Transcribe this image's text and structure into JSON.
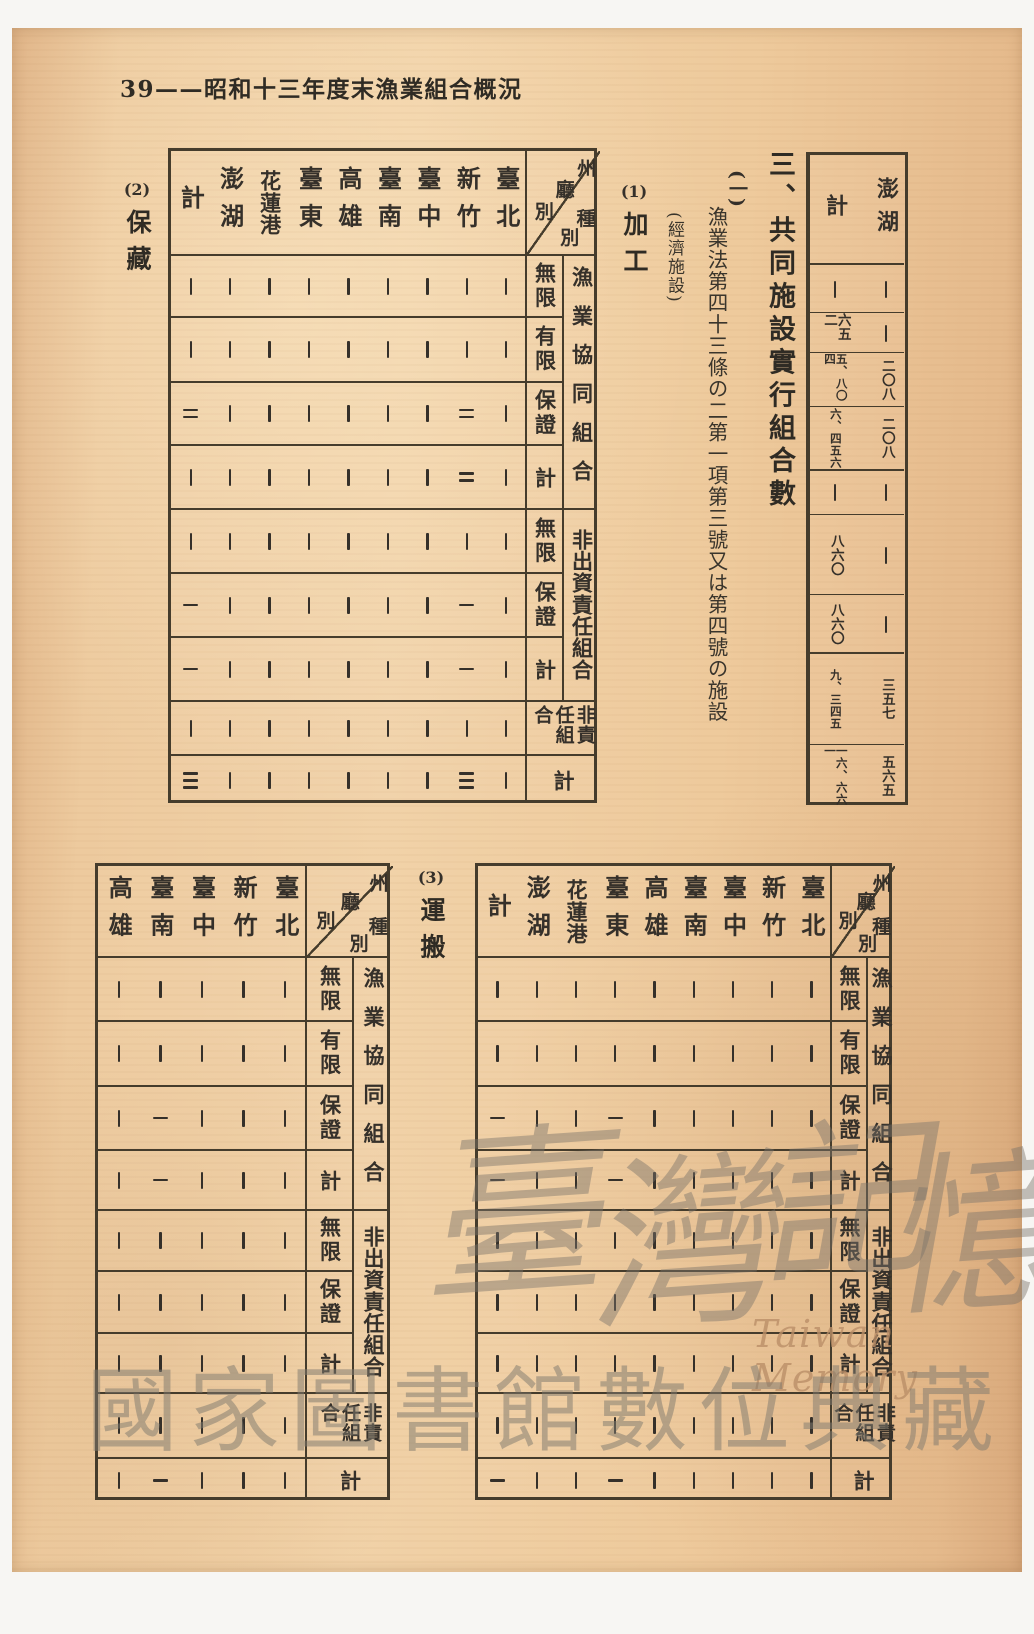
{
  "page_header": "39——昭和十三年度末漁業組合概況",
  "section": {
    "title": "三、共同施設實行組合數",
    "item_marker": "(一)",
    "item_text": "漁業法第四十三條の二第一項第三號又は第四號の施設",
    "item_note": "(經濟施設)"
  },
  "subsections": [
    {
      "num": "(1)",
      "label": "加工"
    },
    {
      "num": "(2)",
      "label": "保藏"
    },
    {
      "num": "(3)",
      "label": "運搬"
    }
  ],
  "axis": {
    "col_axis": "州廳別",
    "row_axis": "種別"
  },
  "row_labels": [
    "無限",
    "有限",
    "保證",
    "計",
    "無限",
    "保證",
    "計",
    "非責任組合",
    "計"
  ],
  "group_labels": [
    "漁業協同組合",
    "非出資責任組合"
  ],
  "continuation_table": {
    "columns": [
      "計",
      "澎湖"
    ],
    "rows": [
      [
        "—",
        "—"
      ],
      [
        "六五二",
        "—"
      ],
      [
        "五、八〇四",
        "二〇八"
      ],
      [
        "六、四五六",
        "二〇八"
      ],
      [
        "—",
        "—"
      ],
      [
        "八六〇",
        "—"
      ],
      [
        "八六〇",
        "—"
      ],
      [
        "九、三四五",
        "三五七"
      ],
      [
        "一六、六六一",
        "五六五"
      ]
    ]
  },
  "table_processing": {
    "columns": [
      "計",
      "澎湖",
      "花蓮港",
      "臺東",
      "高雄",
      "臺南",
      "臺中",
      "新竹",
      "臺北"
    ],
    "rows": [
      [
        "—",
        "—",
        "—",
        "—",
        "—",
        "—",
        "—",
        "—",
        "—"
      ],
      [
        "—",
        "—",
        "—",
        "—",
        "—",
        "—",
        "—",
        "—",
        "—"
      ],
      [
        "二",
        "—",
        "—",
        "—",
        "—",
        "—",
        "—",
        "二",
        "—"
      ],
      [
        "—",
        "—",
        "—",
        "—",
        "—",
        "—",
        "—",
        "二",
        "—"
      ],
      [
        "—",
        "—",
        "—",
        "—",
        "—",
        "—",
        "—",
        "—",
        "—"
      ],
      [
        "一",
        "—",
        "—",
        "—",
        "—",
        "—",
        "—",
        "一",
        "—"
      ],
      [
        "一",
        "—",
        "—",
        "—",
        "—",
        "—",
        "—",
        "一",
        "—"
      ],
      [
        "—",
        "—",
        "—",
        "—",
        "—",
        "—",
        "—",
        "—",
        "—"
      ],
      [
        "三",
        "—",
        "—",
        "—",
        "—",
        "—",
        "—",
        "三",
        "—"
      ]
    ]
  },
  "table_storage": {
    "columns": [
      "計",
      "澎湖",
      "花蓮港",
      "臺東",
      "高雄",
      "臺南",
      "臺中",
      "新竹",
      "臺北"
    ],
    "rows": [
      [
        "—",
        "—",
        "—",
        "—",
        "—",
        "—",
        "—",
        "—",
        "—"
      ],
      [
        "—",
        "—",
        "—",
        "—",
        "—",
        "—",
        "—",
        "—",
        "—"
      ],
      [
        "一",
        "—",
        "—",
        "一",
        "—",
        "—",
        "—",
        "—",
        "—"
      ],
      [
        "一",
        "—",
        "—",
        "一",
        "—",
        "—",
        "—",
        "—",
        "—"
      ],
      [
        "—",
        "—",
        "—",
        "—",
        "—",
        "—",
        "—",
        "—",
        "—"
      ],
      [
        "—",
        "—",
        "—",
        "—",
        "—",
        "—",
        "—",
        "—",
        "—"
      ],
      [
        "—",
        "—",
        "—",
        "—",
        "—",
        "—",
        "—",
        "—",
        "—"
      ],
      [
        "—",
        "—",
        "—",
        "—",
        "—",
        "—",
        "—",
        "—",
        "—"
      ],
      [
        "一",
        "—",
        "—",
        "一",
        "—",
        "—",
        "—",
        "—",
        "—"
      ]
    ]
  },
  "table_transport": {
    "columns": [
      "高雄",
      "臺南",
      "臺中",
      "新竹",
      "臺北"
    ],
    "rows": [
      [
        "—",
        "—",
        "—",
        "—",
        "—"
      ],
      [
        "—",
        "—",
        "—",
        "—",
        "—"
      ],
      [
        "—",
        "一",
        "—",
        "—",
        "—"
      ],
      [
        "—",
        "一",
        "—",
        "—",
        "—"
      ],
      [
        "—",
        "—",
        "—",
        "—",
        "—"
      ],
      [
        "—",
        "—",
        "—",
        "—",
        "—"
      ],
      [
        "—",
        "—",
        "—",
        "—",
        "—"
      ],
      [
        "—",
        "—",
        "—",
        "—",
        "—"
      ],
      [
        "—",
        "一",
        "—",
        "—",
        "—"
      ]
    ]
  },
  "watermark": {
    "script_chars": [
      "臺",
      "灣",
      "記",
      "憶"
    ],
    "latin": "Taiwan Memory",
    "library": "國家圖書館數位典藏"
  },
  "colors": {
    "paper": "#ecc89d",
    "ink": "#35302a",
    "border": "#453c2c",
    "watermark_gray": "#807a70",
    "watermark_latin": "#ba8e68"
  }
}
